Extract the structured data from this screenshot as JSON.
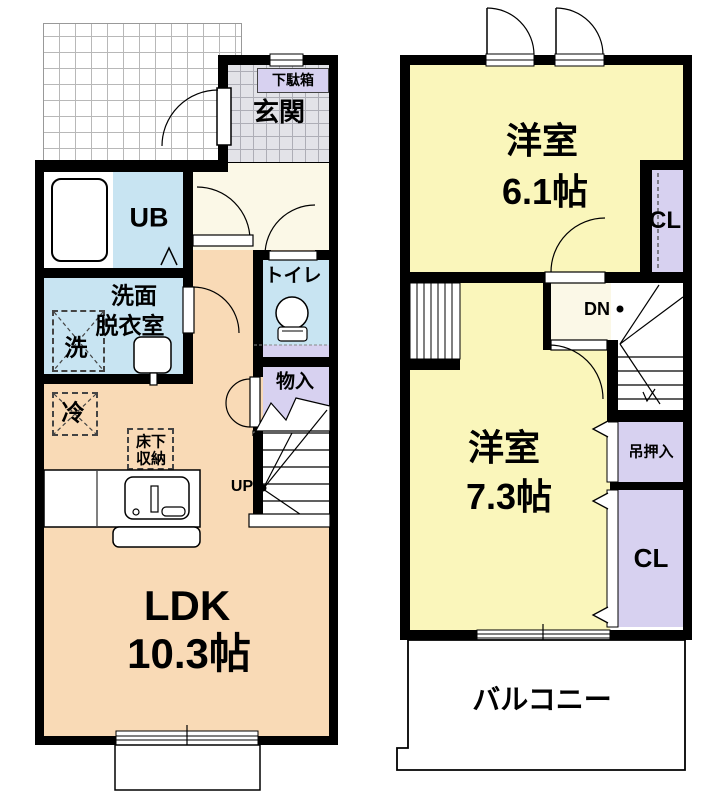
{
  "colors": {
    "wall": "#000000",
    "ldk_peach": "#F9DAB6",
    "bedroom_yellow": "#FAF6BB",
    "water_blue": "#C8E4F2",
    "closet_lavender": "#D7D1F0",
    "hall_cream": "#FBF8E7",
    "entrance_tile_gray": "#E3E3E8"
  },
  "floor1": {
    "shoebox_label": "下駄箱",
    "entrance_label": "玄関",
    "bath_label": "UB",
    "washroom_label_1": "洗面",
    "washroom_label_2": "脱衣室",
    "washer_label": "洗",
    "toilet_label": "トイレ",
    "storage_label": "物入",
    "fridge_label": "冷",
    "underfloor_label_1": "床下",
    "underfloor_label_2": "収納",
    "stairs_label": "UP",
    "ldk_label_1": "LDK",
    "ldk_label_2": "10.3帖"
  },
  "floor2": {
    "bedroom1_label_1": "洋室",
    "bedroom1_label_2": "6.1帖",
    "closet_upper_label": "CL",
    "stairs_label": "DN",
    "bedroom2_label_1": "洋室",
    "bedroom2_label_2": "7.3帖",
    "hanging_closet_label": "吊押入",
    "closet_lower_label": "CL",
    "balcony_label": "バルコニー"
  }
}
